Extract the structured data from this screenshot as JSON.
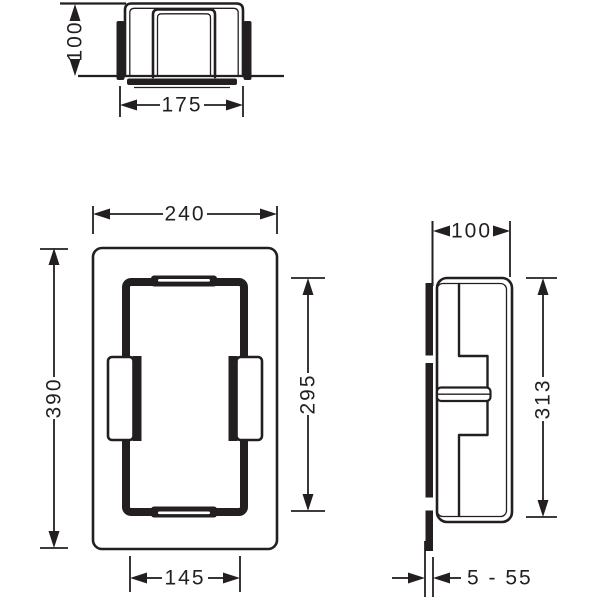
{
  "colors": {
    "ink": "#231f20",
    "background": "#ffffff"
  },
  "views": {
    "top": {
      "height": "100",
      "width": "175"
    },
    "front": {
      "width": "240",
      "height": "390",
      "inner_height": "295",
      "inner_width": "145"
    },
    "side": {
      "depth": "100",
      "height": "313",
      "depth_range": "5 - 55"
    }
  }
}
